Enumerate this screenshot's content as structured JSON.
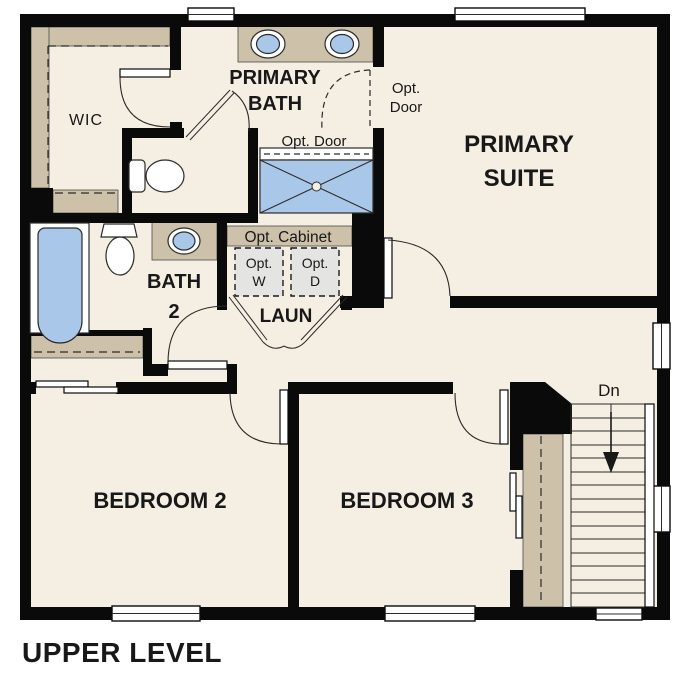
{
  "title": "UPPER LEVEL",
  "colors": {
    "floor": "#f5eee2",
    "casework_tan": "#cdc1a9",
    "fixture_blue": "#a9c8e9",
    "appliance_gray": "#e4e4e3",
    "wall_black": "#0a0a0a"
  },
  "rooms": {
    "wic": {
      "label": "WIC"
    },
    "primary_bath": {
      "label_line1": "PRIMARY",
      "label_line2": "BATH"
    },
    "primary_suite": {
      "label_line1": "PRIMARY",
      "label_line2": "SUITE"
    },
    "bath2": {
      "label_line1": "BATH",
      "label_line2": "2"
    },
    "laundry": {
      "label": "LAUN"
    },
    "bedroom2": {
      "label": "BEDROOM 2"
    },
    "bedroom3": {
      "label": "BEDROOM 3"
    }
  },
  "annotations": {
    "opt_door_shower": "Opt. Door",
    "opt_door_suite_line1": "Opt.",
    "opt_door_suite_line2": "Door",
    "opt_cabinet": "Opt. Cabinet",
    "opt_washer_line1": "Opt.",
    "opt_washer_line2": "W",
    "opt_dryer_line1": "Opt.",
    "opt_dryer_line2": "D",
    "stairs_down": "Dn"
  }
}
